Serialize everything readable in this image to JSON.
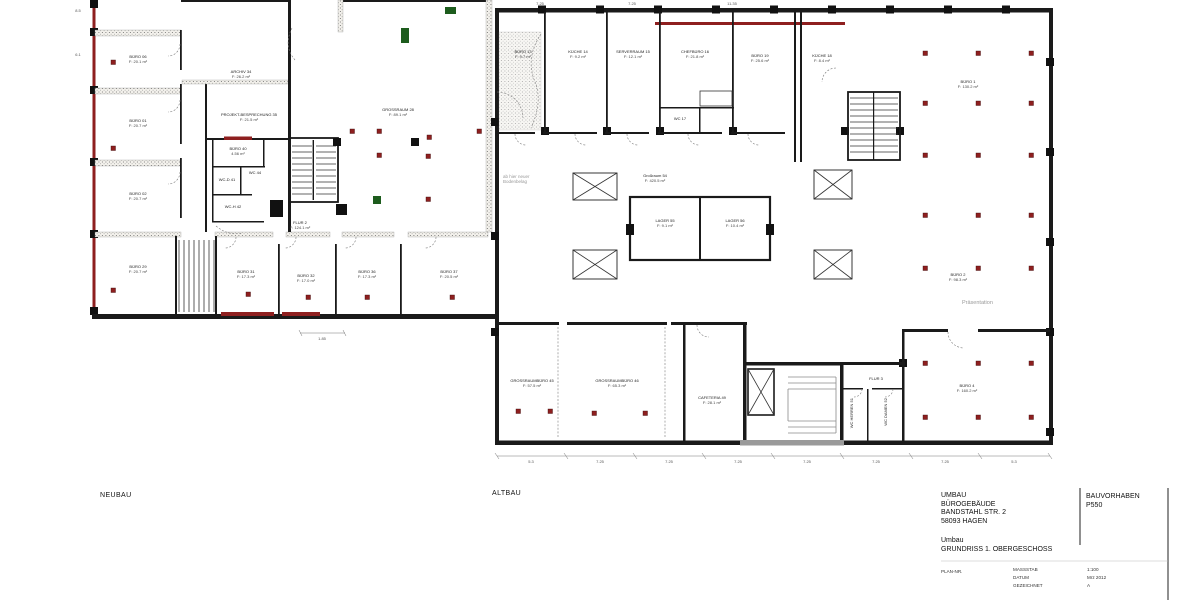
{
  "section_labels": {
    "neubau": "NEUBAU",
    "altbau": "ALTBAU"
  },
  "title_block": {
    "line1": "UMBAU",
    "line2": "BÜROGEBÄUDE",
    "line3": "BANDSTAHL STR. 2",
    "line4": "58093 HAGEN",
    "phase": "Umbau",
    "drawing_title": "GRUNDRISS 1. OBERGESCHOSS",
    "bauvorhaben_label": "BAUVORHABEN",
    "bauvorhaben_value": "P550",
    "plan_nr_label": "PLAN-NR.",
    "massstab_label": "MASSSTAB",
    "massstab_value": "1:100",
    "datum_label": "DATUM",
    "datum_value": "Mrz 2012",
    "gezeichnet_label": "GEZEICHNET",
    "gezeichnet_value": "A"
  },
  "rooms": {
    "neubau": [
      {
        "label": "BÜRO 06",
        "area": "F: 20.1 m²"
      },
      {
        "label": "BÜRO 01",
        "area": "F: 20.7 m²"
      },
      {
        "label": "BÜRO 02",
        "area": "F: 20.7 m²"
      },
      {
        "label": "BÜRO 29",
        "area": "F: 20.7 m²"
      },
      {
        "label": "ARCHIV 34",
        "area": "F: 26.2 m²"
      },
      {
        "label": "PROJEKT-BESPRECHUNG 35",
        "area": "F: 21.5 m²"
      },
      {
        "label": "BÜRO 40",
        "area": "4.56 m²"
      },
      {
        "label": "WC-D 41",
        "area": ""
      },
      {
        "label": "WC 44",
        "area": ""
      },
      {
        "label": "WC-H 42",
        "area": ""
      },
      {
        "label": "FLUR 2",
        "area": "F: 124.1 m²"
      },
      {
        "label": "GROSSRAUM 28",
        "area": "F: 89.1 m²"
      },
      {
        "label": "BÜRO 31",
        "area": "F: 17.3 m²"
      },
      {
        "label": "BÜRO 32",
        "area": "F: 17.0 m²"
      },
      {
        "label": "BÜRO 36",
        "area": "F: 17.3 m²"
      },
      {
        "label": "BÜRO 37",
        "area": "F: 20.5 m²"
      }
    ],
    "altbau": [
      {
        "label": "BÜRO 13",
        "area": "F: 9.7 m²"
      },
      {
        "label": "KÜCHE 14",
        "area": "F: 9.2 m²"
      },
      {
        "label": "SERVERRAUM 15",
        "area": "F: 12.1 m²"
      },
      {
        "label": "CHEFBÜRO 16",
        "area": "F: 21.8 m²"
      },
      {
        "label": "BÜRO 19",
        "area": "F: 25.6 m²"
      },
      {
        "label": "KÜCHE 18",
        "area": "F: 8.4 m²"
      },
      {
        "label": "WC 17",
        "area": ""
      },
      {
        "label": "Großraum 54",
        "area": "F: 420.5 m²"
      },
      {
        "label": "LAGER 55",
        "area": "F: 9.1 m²"
      },
      {
        "label": "LAGER 56",
        "area": "F: 10.4 m²"
      },
      {
        "label": "BÜRO 1",
        "area": "F: 130.2 m²"
      },
      {
        "label": "BÜRO 2",
        "area": "F: 98.3 m²"
      },
      {
        "label": "BÜRO 4",
        "area": "F: 160.2 m²"
      },
      {
        "label": "GROSSRAUMBÜRO 45",
        "area": "F: 57.5 m²"
      },
      {
        "label": "GROSSRAUMBÜRO 46",
        "area": "F: 65.3 m²"
      },
      {
        "label": "CAFETERIA 49",
        "area": "F: 28.1 m²"
      },
      {
        "label": "FLUR 3",
        "area": ""
      },
      {
        "label": "WC HERREN 51",
        "area": ""
      },
      {
        "label": "WC DAMEN 52",
        "area": ""
      }
    ]
  },
  "annotations": {
    "floor_note_line1": "ab hier neuer",
    "floor_note_line2": "Bodenbelag",
    "presentation_note": "Präsentation"
  },
  "dims": {
    "top": [
      "7.25",
      "7.25",
      "11.35"
    ],
    "left": [
      "8.5",
      "6.1"
    ],
    "neubau_bottom": "1.85",
    "bottom": [
      "5.3",
      "7.25",
      "7.25",
      "7.25",
      "7.25",
      "7.25",
      "7.25",
      "5.3"
    ]
  }
}
